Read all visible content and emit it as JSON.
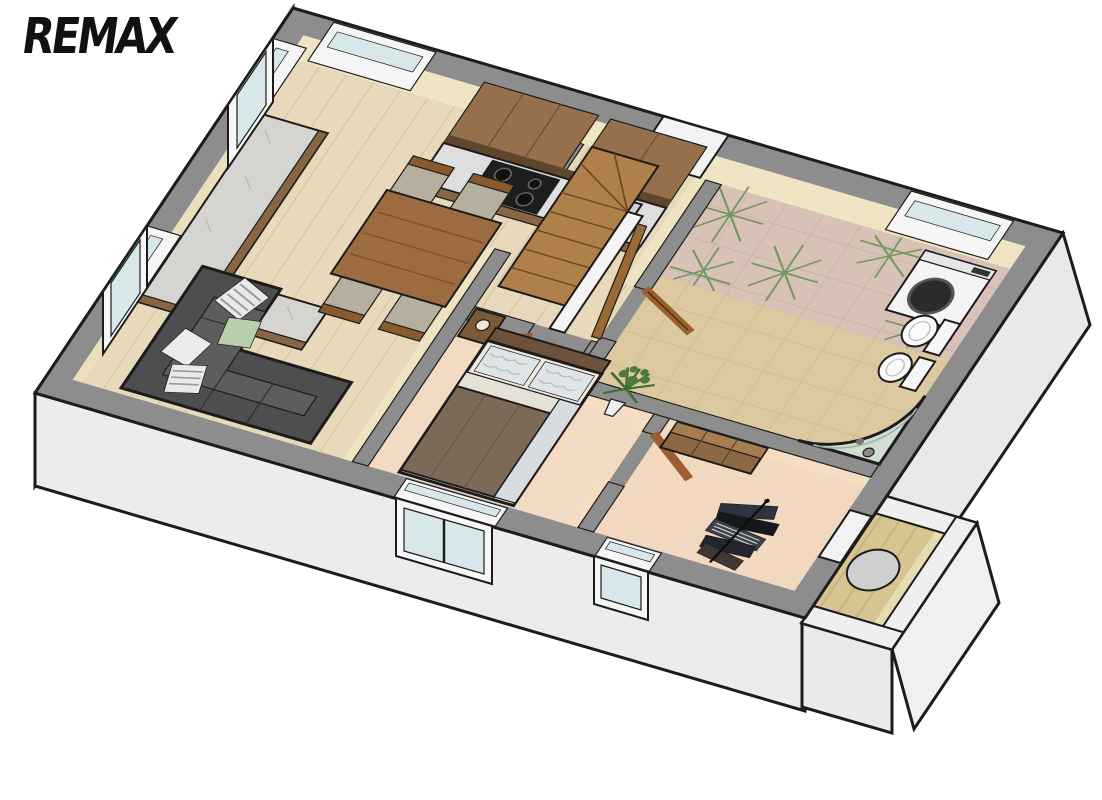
{
  "logo": {
    "text": "REMAX",
    "color": "#111111"
  },
  "scene": {
    "description": "3D isometric cutaway floor plan render of a one-storey apartment, viewed from above at an angle",
    "rooms": [
      {
        "id": "living-room-with-kitchen",
        "features": [
          "u-shaped-kitchen-counter",
          "marble-worktop",
          "wall-cabinets",
          "stove-cooktop",
          "kitchen-sink",
          "dining-table",
          "four-chairs",
          "corner-sofa",
          "striped-pillows",
          "green-pillow",
          "left-wall-window-upper",
          "left-wall-window-lower",
          "kitchen-window-top-wall"
        ]
      },
      {
        "id": "entrance-hall",
        "features": [
          "winder-staircase",
          "stair-balustrade",
          "handrail",
          "entry-door-open",
          "door-to-living-room"
        ]
      },
      {
        "id": "bathroom",
        "features": [
          "patterned-pink-tiles-with-green-stars",
          "tan-floor-tiles",
          "washing-machine",
          "wall-hung-toilet",
          "wall-hung-bidet",
          "corner-glass-shower",
          "bathroom-window",
          "door-open"
        ]
      },
      {
        "id": "main-bedroom",
        "features": [
          "double-bed-brown-duvet",
          "nightstand",
          "table-lamp",
          "potted-plant",
          "double-window-bottom-wall",
          "door-open"
        ]
      },
      {
        "id": "second-bedroom",
        "features": [
          "clothes-rack-with-garments",
          "wooden-dresser",
          "small-window-bottom-wall",
          "balcony-door"
        ]
      },
      {
        "id": "balcony",
        "features": [
          "wooden-deck",
          "round-table",
          "white-parapet-walls"
        ]
      }
    ]
  },
  "colors": {
    "background": "#ffffff",
    "outline": "#1c1c1c",
    "wall_top": "#8d8d8d",
    "wall_exterior": "#f0f0f0",
    "wall_interior_cream": "#f0e5c2",
    "wall_interior_peach": "#f5dcc2",
    "floor_wood": "#e7d9ba",
    "floor_bedroom": "#f3dac2",
    "tile_pink": "#d8c2b8",
    "tile_tan": "#dcc9a0",
    "tile_star_green": "#72975f",
    "counter_marble": "#d6d4d0",
    "cabinet_wood": "#96704c",
    "furniture_wood": "#9c6b3f",
    "door_wood": "#9a5f2e",
    "stair_wood": "#b0804a",
    "sofa_gray": "#4e4e4e",
    "bed_duvet": "#7b6a57",
    "glass_blue": "#d7e7ea",
    "deck_wood": "#d8c491"
  }
}
